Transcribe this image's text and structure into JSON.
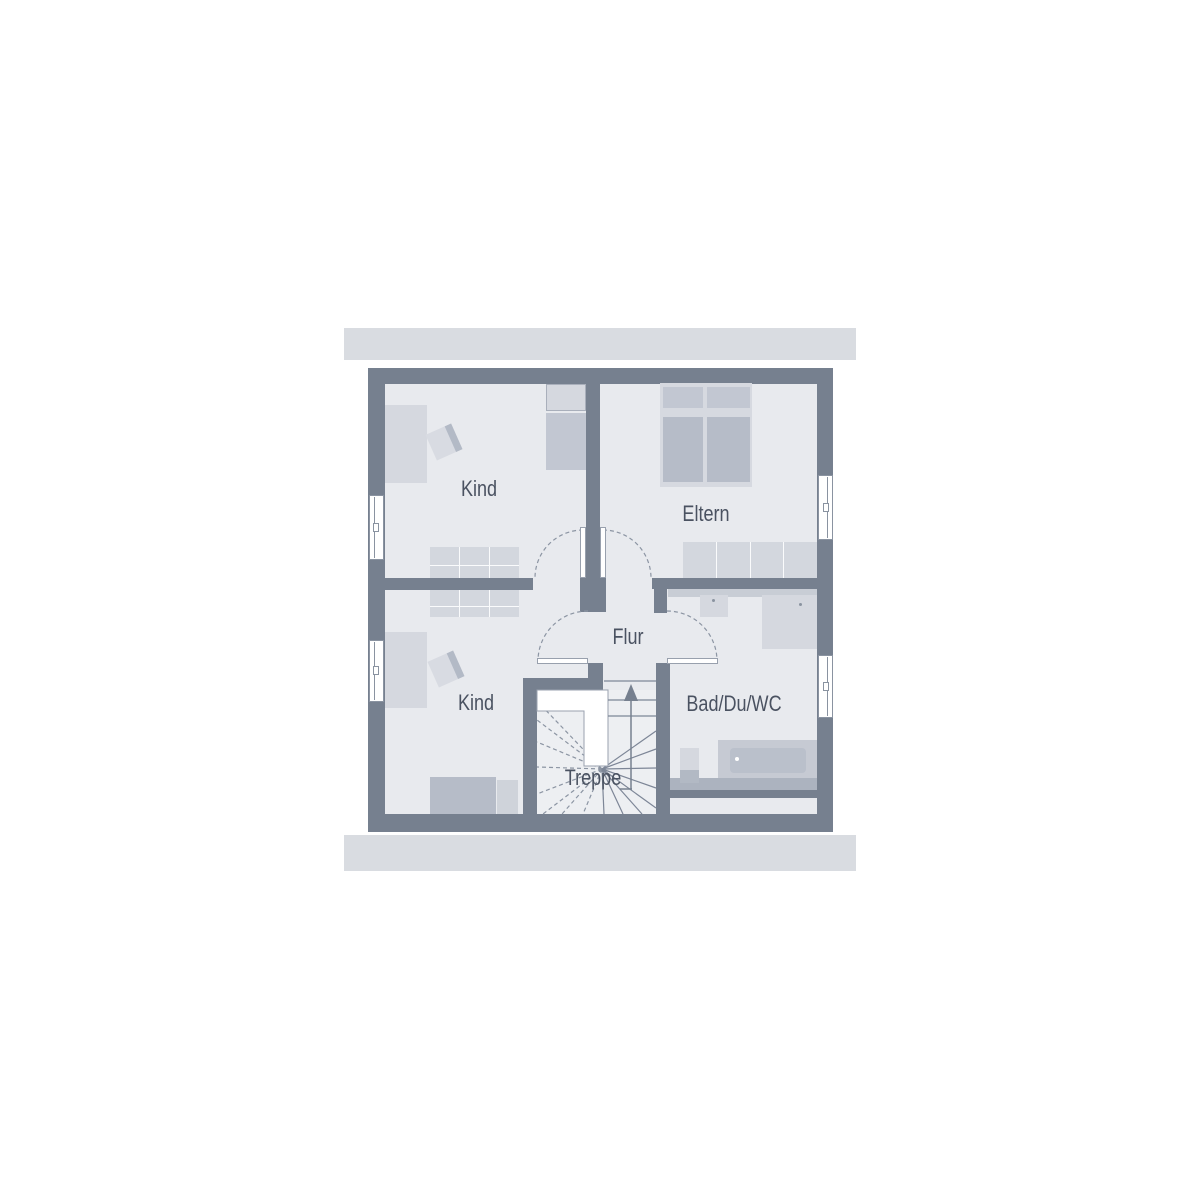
{
  "rooms": {
    "kind_top": {
      "label": "Kind"
    },
    "eltern": {
      "label": "Eltern"
    },
    "kind_bottom": {
      "label": "Kind"
    },
    "flur": {
      "label": "Flur"
    },
    "treppe": {
      "label": "Treppe"
    },
    "bad": {
      "label": "Bad/Du/WC"
    }
  },
  "colors": {
    "wall": "#76808F",
    "floor": "#E8EAEE",
    "stair_floor": "#EDEFF2",
    "roof_band": "#D9DCE1",
    "furniture_light": "#D5D8DF",
    "furniture_medium": "#C2C7D2",
    "furniture_dark": "#B6BCC8",
    "line": "#8C95A3",
    "text": "#4A5261",
    "window": "#FFFFFF"
  }
}
